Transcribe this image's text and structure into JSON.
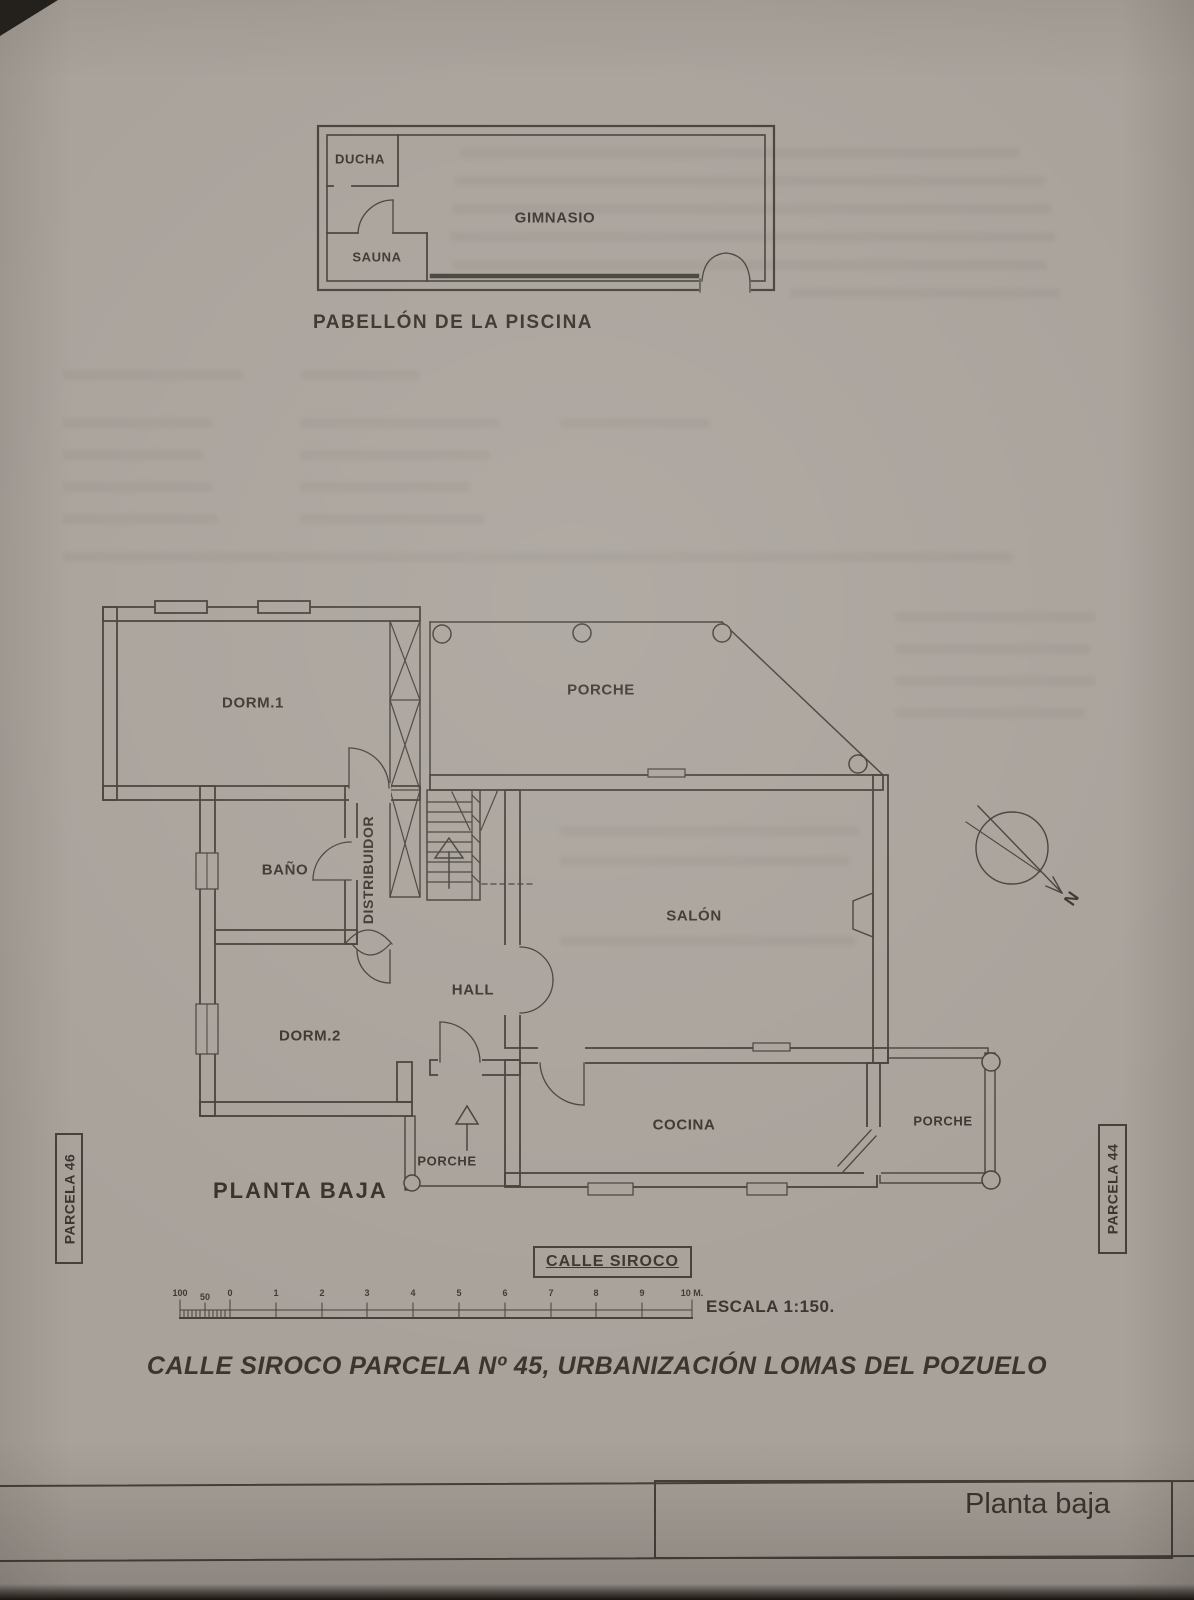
{
  "document": {
    "paper_color": "#a9a29b",
    "ink_color": "#45403a"
  },
  "pavilion_plan": {
    "rooms": {
      "ducha": "DUCHA",
      "sauna": "SAUNA",
      "gimnasio": "GIMNASIO"
    },
    "caption": "PABELLÓN DE LA PISCINA"
  },
  "ground_floor_plan": {
    "rooms": {
      "dorm1": "DORM.1",
      "porche_top": "PORCHE",
      "bano": "BAÑO",
      "distribuidor": "DISTRIBUIDOR",
      "salon": "SALÓN",
      "hall": "HALL",
      "dorm2": "DORM.2",
      "cocina": "COCINA",
      "porche_entry": "PORCHE",
      "porche_right": "PORCHE"
    },
    "caption": "PLANTA BAJA",
    "compass_label": "N"
  },
  "site_labels": {
    "parcel_left": "PARCELA 46",
    "parcel_right": "PARCELA 44",
    "street": "CALLE SIROCO"
  },
  "scale_bar": {
    "ticks": [
      "100",
      "50",
      "0",
      "1",
      "2",
      "3",
      "4",
      "5",
      "6",
      "7",
      "8",
      "9",
      "10 M."
    ],
    "scale_text": "ESCALA 1:150."
  },
  "drawing_title": "CALLE SIROCO PARCELA Nº 45, URBANIZACIÓN LOMAS DEL POZUELO",
  "title_block": {
    "sheet_name": "Planta baja"
  }
}
